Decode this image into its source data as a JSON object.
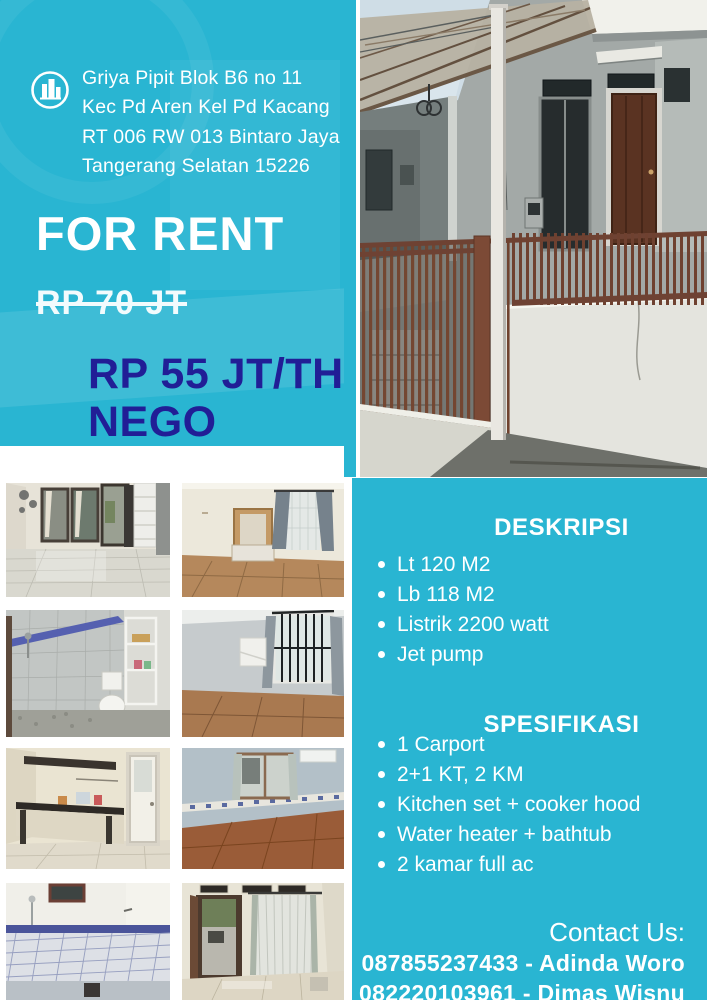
{
  "colors": {
    "teal": "#29b5d2",
    "navy": "#211e96",
    "white": "#ffffff"
  },
  "header": {
    "logo_icon": "building-logo-icon",
    "address": {
      "lines": [
        "Griya Pipit Blok B6 no 11",
        "Kec Pd Aren Kel Pd Kacang",
        "RT 006 RW 013 Bintaro Jaya",
        "Tangerang Selatan 15226"
      ]
    }
  },
  "offer": {
    "headline": "FOR RENT",
    "old_price": "RP 70 JT",
    "price": "RP 55 JT/TH",
    "price_note": "NEGO"
  },
  "deskripsi": {
    "heading": "DESKRIPSI",
    "items": [
      "Lt 120 M2",
      "Lb 118 M2",
      "Listrik 2200 watt",
      "Jet pump"
    ]
  },
  "spesifikasi": {
    "heading": "SPESIFIKASI",
    "items": [
      "1 Carport",
      "2+1 KT, 2 KM",
      "Kitchen set + cooker hood",
      "Water heater + bathtub",
      "2 kamar full ac"
    ]
  },
  "contact": {
    "label": "Contact Us:",
    "lines": [
      "087855237433 - Adinda Woro",
      "082220103961 - Dimas Wisnu"
    ]
  }
}
